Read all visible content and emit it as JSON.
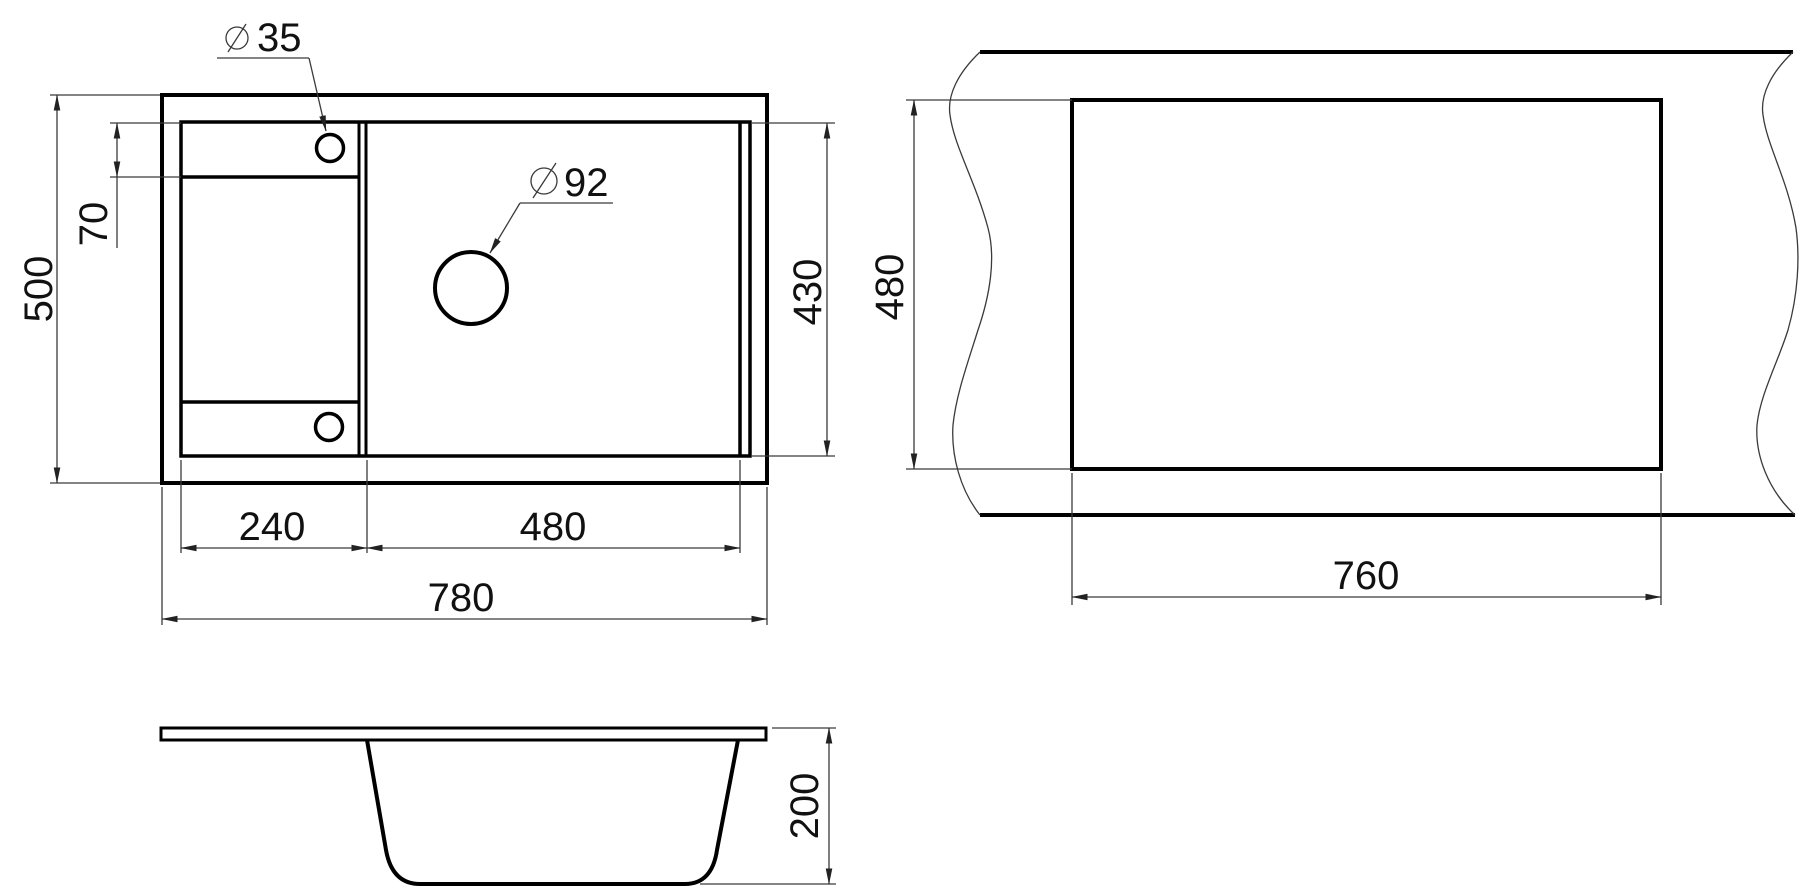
{
  "title": "Kitchen sink dimensional drawing",
  "units": "mm",
  "views": {
    "plan": {
      "label": "sink top view",
      "dims": {
        "overall_width": "780",
        "overall_depth": "500",
        "drainer_width": "240",
        "bowl_width": "480",
        "bowl_front_back": "430",
        "tap_hole_offset": "70",
        "tap_hole_diameter": "35",
        "drain_hole_diameter": "92"
      }
    },
    "cutout": {
      "label": "worktop cutout view",
      "dims": {
        "cutout_width": "760",
        "cutout_depth": "480"
      }
    },
    "profile": {
      "label": "side profile view",
      "dims": {
        "bowl_depth": "200"
      }
    }
  }
}
